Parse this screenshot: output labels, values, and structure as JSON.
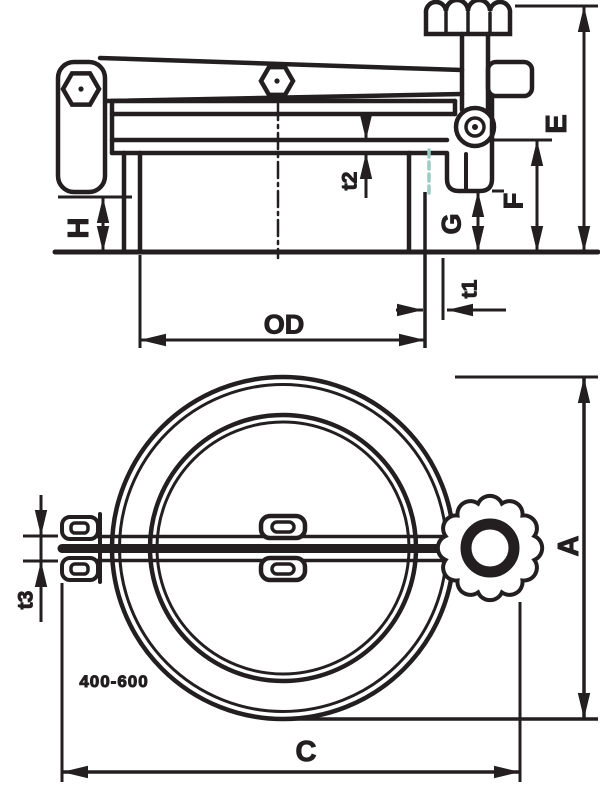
{
  "drawing": {
    "background_color": "#ffffff",
    "line_color": "#231f20",
    "hidden_line_color": "#9cccc2",
    "views": {
      "side_view": {
        "dimension_labels": [
          "E",
          "F",
          "G",
          "H",
          "t1",
          "t2",
          "OD"
        ]
      },
      "plan_view": {
        "dimension_labels": [
          "A",
          "C",
          "t3"
        ],
        "note": "400-600"
      }
    }
  },
  "labels": {
    "E": "E",
    "F": "F",
    "G": "G",
    "H": "H",
    "t1": "t1",
    "t2": "t2",
    "t3": "t3",
    "OD": "OD",
    "A": "A",
    "C": "C",
    "size_range": "400-600"
  }
}
